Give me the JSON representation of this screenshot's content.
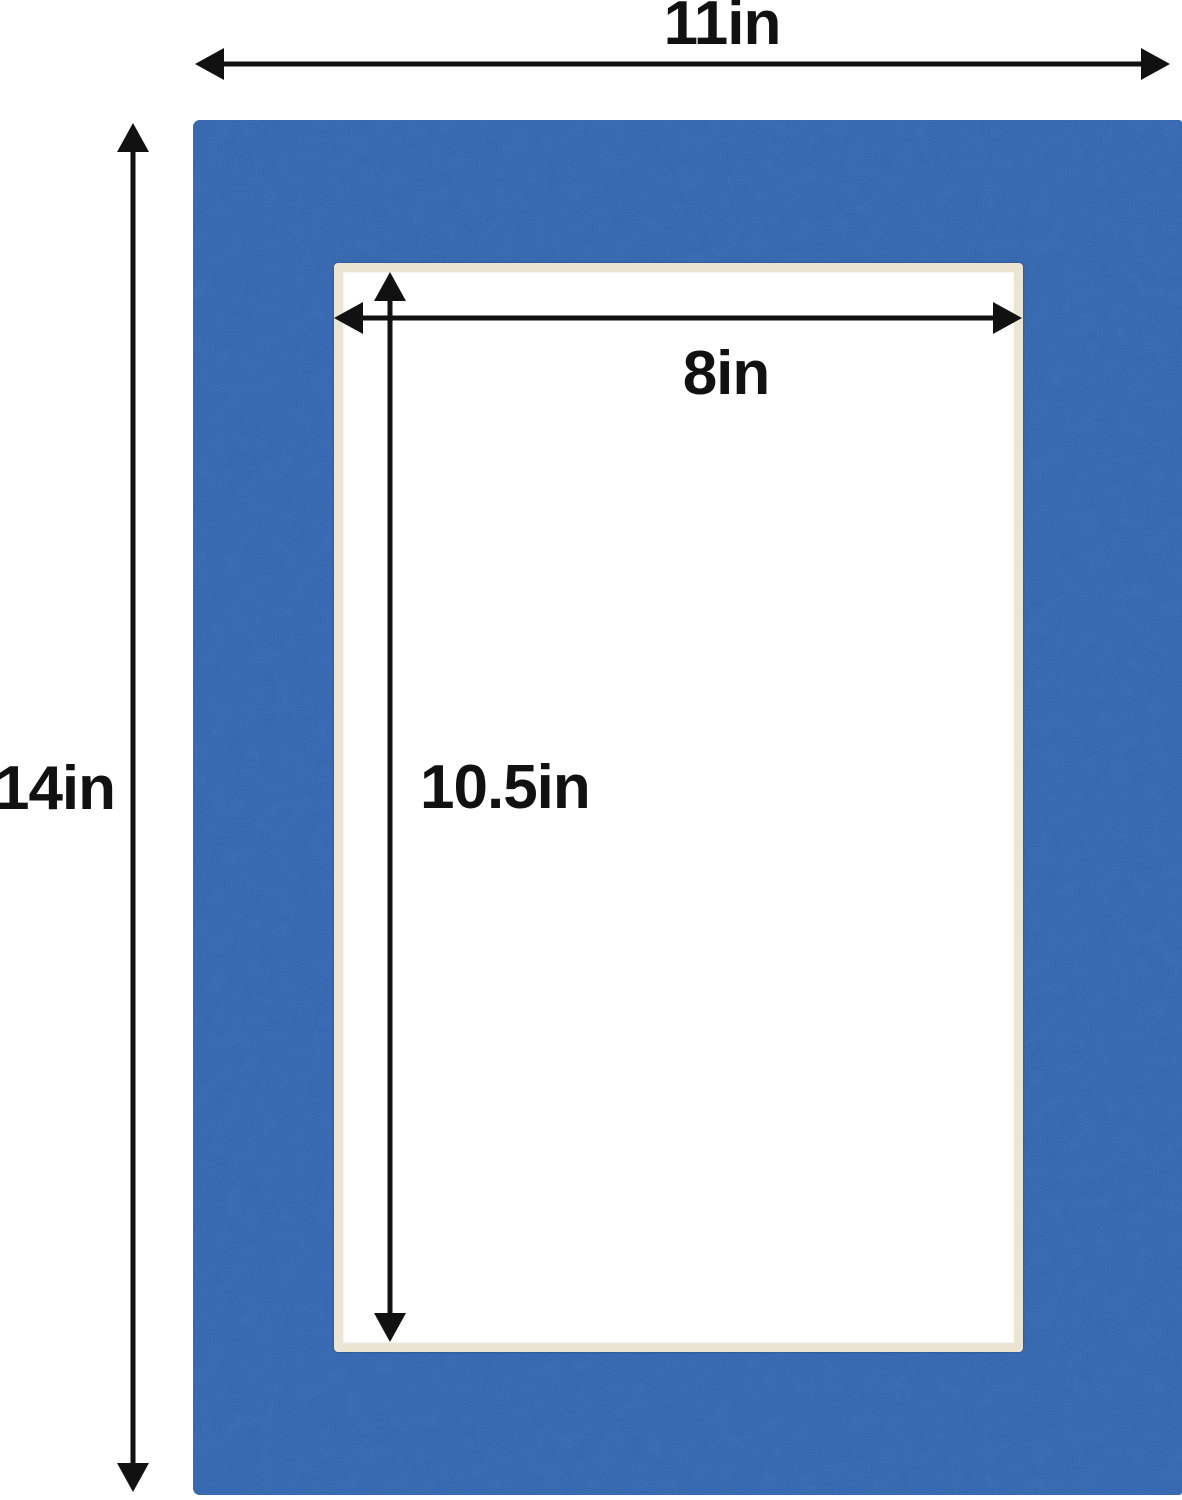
{
  "diagram": {
    "outer": {
      "width_label": "11in",
      "height_label": "14in"
    },
    "window": {
      "width_label": "8in",
      "height_label": "10.5in"
    }
  },
  "colors": {
    "mat_blue": "#3362ab",
    "mat_bevel_cream": "#ece5d1",
    "window_white": "#ffffff",
    "dimension_ink": "#111111",
    "background": "#ffffff"
  }
}
